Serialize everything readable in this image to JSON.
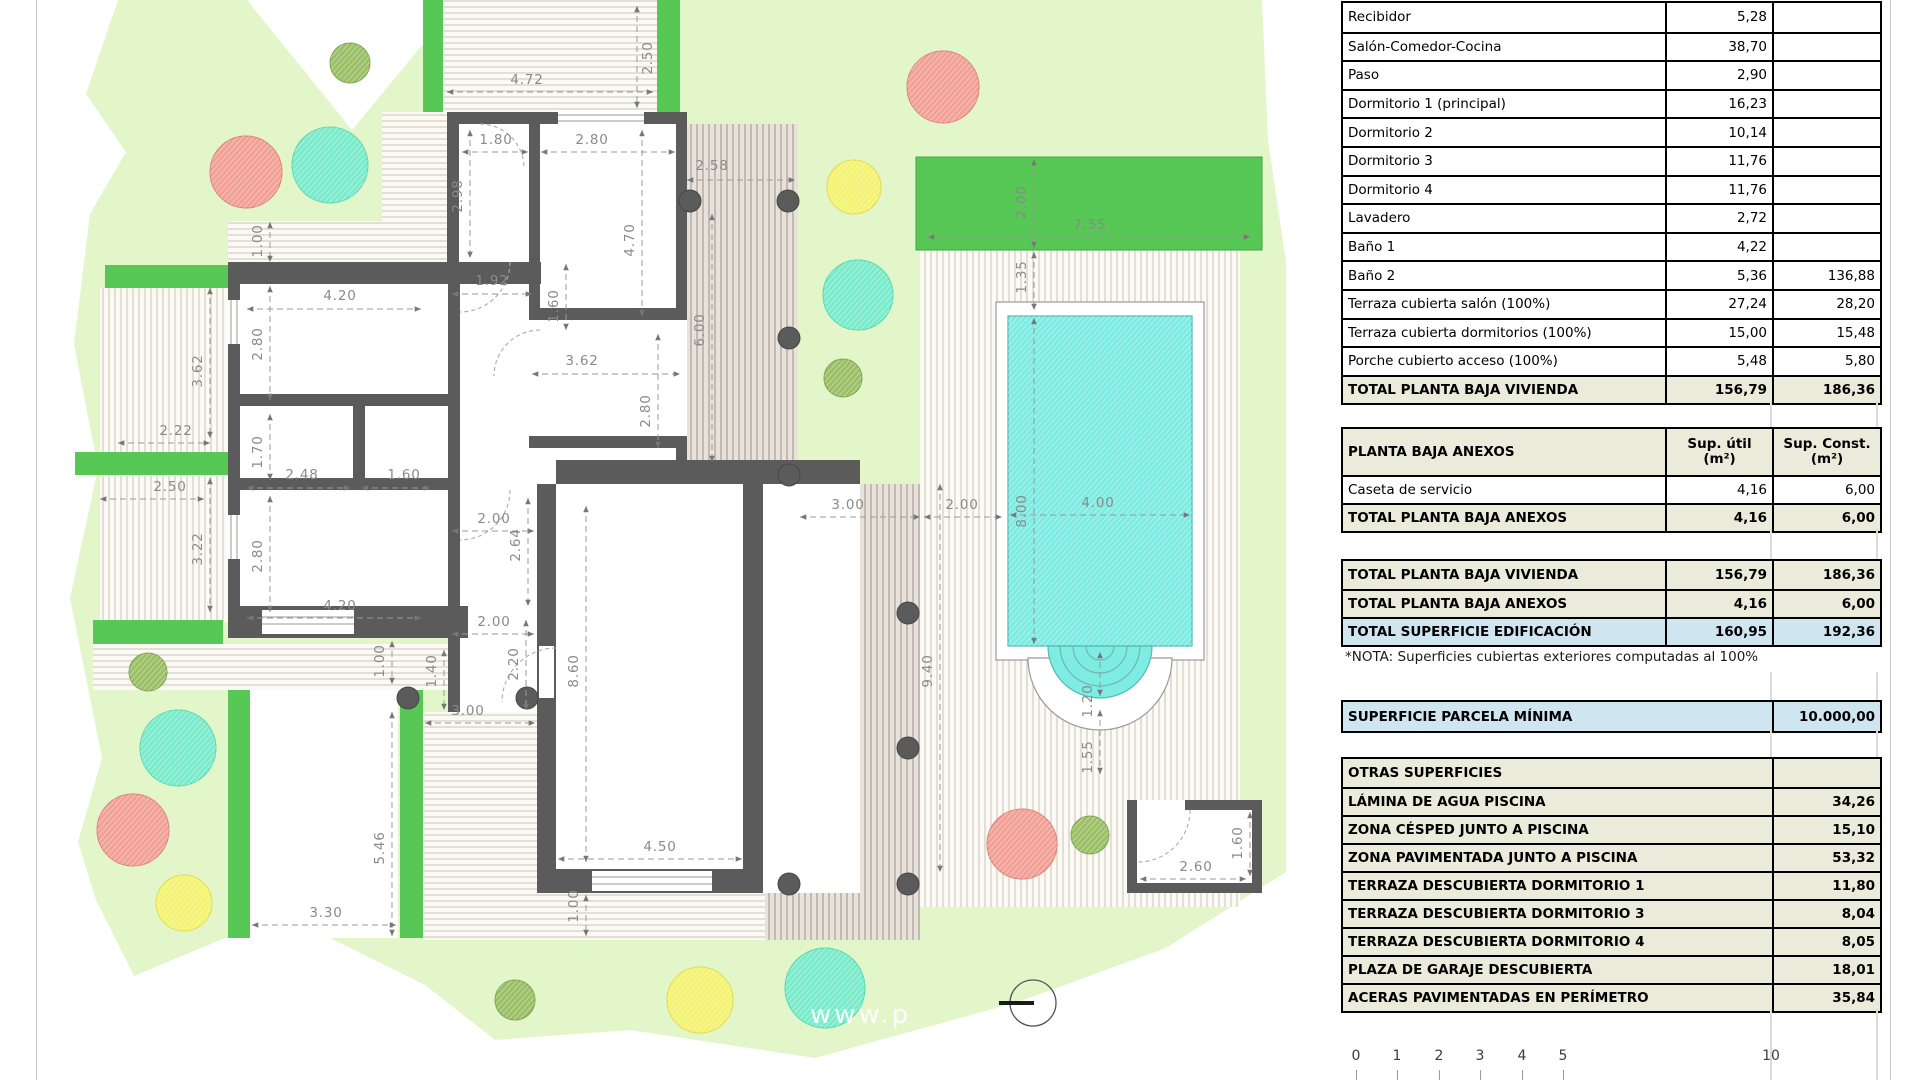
{
  "colors": {
    "parcel": "#E2F6CA",
    "hedge": "#57C756",
    "wall": "#5B5B5B",
    "pool_water": "#7EECE3",
    "table_total_bg": "#EBEBDB",
    "table_blue_bg": "#CFE6F1"
  },
  "plan": {
    "watermark": "www.p",
    "dimensions": [
      [
        "2.50",
        648,
        58,
        1,
        637,
        6,
        637,
        108
      ],
      [
        "4.72",
        527,
        80,
        0,
        447,
        92,
        653,
        92
      ],
      [
        "1.80",
        496,
        140,
        0,
        462,
        152,
        528,
        152
      ],
      [
        "2.80",
        592,
        140,
        0,
        541,
        152,
        675,
        152
      ],
      [
        "2.98",
        458,
        196,
        1,
        470,
        130,
        470,
        258
      ],
      [
        "4.70",
        630,
        240,
        1,
        642,
        130,
        642,
        316
      ],
      [
        "2.58",
        712,
        166,
        0,
        687,
        180,
        795,
        180
      ],
      [
        "1.00",
        258,
        241,
        1,
        270,
        222,
        270,
        262
      ],
      [
        "4.20",
        340,
        296,
        0,
        247,
        309,
        421,
        309
      ],
      [
        "2.80",
        258,
        344,
        1,
        270,
        286,
        270,
        400
      ],
      [
        "3.62",
        198,
        371,
        1,
        210,
        288,
        210,
        438
      ],
      [
        "1.92",
        492,
        281,
        0,
        452,
        294,
        532,
        294
      ],
      [
        "1.60",
        554,
        306,
        1,
        566,
        264,
        566,
        330
      ],
      [
        "3.62",
        582,
        361,
        0,
        532,
        374,
        680,
        374
      ],
      [
        "6.00",
        700,
        330,
        1,
        712,
        214,
        712,
        462
      ],
      [
        "2.22",
        176,
        431,
        0,
        118,
        443,
        210,
        443
      ],
      [
        "1.70",
        258,
        452,
        1,
        270,
        414,
        270,
        480
      ],
      [
        "2.48",
        302,
        475,
        0,
        247,
        488,
        350,
        488
      ],
      [
        "1.60",
        404,
        475,
        0,
        362,
        488,
        430,
        488
      ],
      [
        "2.50",
        170,
        487,
        0,
        100,
        499,
        204,
        499
      ],
      [
        "3.22",
        198,
        549,
        1,
        210,
        478,
        210,
        612
      ],
      [
        "2.80",
        258,
        556,
        1,
        270,
        496,
        270,
        612
      ],
      [
        "4.20",
        340,
        606,
        0,
        247,
        618,
        421,
        618
      ],
      [
        "2.80",
        646,
        411,
        1,
        658,
        334,
        658,
        448
      ],
      [
        "2.00",
        494,
        519,
        0,
        452,
        531,
        534,
        531
      ],
      [
        "2.64",
        516,
        545,
        1,
        528,
        498,
        528,
        606
      ],
      [
        "2.00",
        494,
        622,
        0,
        452,
        634,
        534,
        634
      ],
      [
        "2.20",
        514,
        664,
        1,
        526,
        620,
        526,
        710
      ],
      [
        "1.40",
        432,
        671,
        1,
        444,
        650,
        444,
        710
      ],
      [
        "1.00",
        380,
        661,
        1,
        392,
        641,
        392,
        684
      ],
      [
        "8.60",
        574,
        671,
        1,
        586,
        506,
        586,
        862
      ],
      [
        "3.00",
        468,
        711,
        0,
        425,
        723,
        535,
        723
      ],
      [
        "5.46",
        380,
        848,
        1,
        392,
        712,
        392,
        936
      ],
      [
        "3.30",
        326,
        913,
        0,
        252,
        925,
        396,
        925
      ],
      [
        "4.50",
        660,
        847,
        0,
        558,
        859,
        742,
        859
      ],
      [
        "1.00",
        574,
        906,
        1,
        586,
        895,
        586,
        936
      ],
      [
        "9.40",
        928,
        671,
        1,
        940,
        484,
        940,
        872
      ],
      [
        "2.00",
        1022,
        202,
        1,
        1034,
        159,
        1034,
        248
      ],
      [
        "7.55",
        1090,
        225,
        0,
        928,
        237,
        1250,
        237
      ],
      [
        "1.35",
        1022,
        277,
        1,
        1034,
        252,
        1034,
        310
      ],
      [
        "8.00",
        1022,
        511,
        1,
        1034,
        318,
        1034,
        644
      ],
      [
        "4.00",
        1098,
        503,
        0,
        1010,
        515,
        1190,
        515
      ],
      [
        "3.00",
        848,
        505,
        0,
        800,
        517,
        920,
        517
      ],
      [
        "2.00",
        962,
        505,
        0,
        924,
        517,
        1002,
        517
      ],
      [
        "1.20",
        1088,
        701,
        1,
        1100,
        652,
        1100,
        696
      ],
      [
        "1.55",
        1088,
        757,
        1,
        1100,
        710,
        1100,
        774
      ],
      [
        "2.60",
        1196,
        867,
        0,
        1140,
        879,
        1246,
        879
      ],
      [
        "1.60",
        1238,
        843,
        1,
        1250,
        812,
        1250,
        876
      ]
    ],
    "scale_bar": [
      [
        "0",
        1356
      ],
      [
        "1",
        1397
      ],
      [
        "2",
        1439
      ],
      [
        "3",
        1480
      ],
      [
        "4",
        1522
      ],
      [
        "5",
        1563
      ],
      [
        "10",
        1771
      ]
    ]
  },
  "tables": {
    "vivienda": {
      "rows": [
        [
          "Recibidor",
          "5,28",
          "",
          "n"
        ],
        [
          "Salón-Comedor-Cocina",
          "38,70",
          "",
          "n"
        ],
        [
          "Paso",
          "2,90",
          "",
          "n"
        ],
        [
          "Dormitorio 1 (principal)",
          "16,23",
          "",
          "n"
        ],
        [
          "Dormitorio 2",
          "10,14",
          "",
          "n"
        ],
        [
          "Dormitorio 3",
          "11,76",
          "",
          "n"
        ],
        [
          "Dormitorio 4",
          "11,76",
          "",
          "n"
        ],
        [
          "Lavadero",
          "2,72",
          "",
          "n"
        ],
        [
          "Baño 1",
          "4,22",
          "",
          "n"
        ],
        [
          "Baño 2",
          "5,36",
          "136,88",
          "n"
        ],
        [
          "Terraza cubierta salón (100%)",
          "27,24",
          "28,20",
          "n"
        ],
        [
          "Terraza cubierta dormitorios (100%)",
          "15,00",
          "15,48",
          "n"
        ],
        [
          "Porche cubierto acceso (100%)",
          "5,48",
          "5,80",
          "n"
        ],
        [
          "TOTAL PLANTA BAJA VIVIENDA",
          "156,79",
          "186,36",
          "t"
        ]
      ]
    },
    "anexos": {
      "title": "PLANTA BAJA ANEXOS",
      "col1a": "Sup. útil",
      "col1b": "(m²)",
      "col2a": "Sup. Const.",
      "col2b": "(m²)",
      "rows": [
        [
          "Caseta de servicio",
          "4,16",
          "6,00",
          "n"
        ],
        [
          "TOTAL PLANTA BAJA ANEXOS",
          "4,16",
          "6,00",
          "t"
        ]
      ]
    },
    "resumen": {
      "rows": [
        [
          "TOTAL PLANTA BAJA VIVIENDA",
          "156,79",
          "186,36",
          "t"
        ],
        [
          "TOTAL PLANTA BAJA ANEXOS",
          "4,16",
          "6,00",
          "t"
        ],
        [
          "TOTAL SUPERFICIE EDIFICACIÓN",
          "160,95",
          "192,36",
          "b"
        ]
      ]
    },
    "nota": "*NOTA: Superficies cubiertas exteriores computadas al 100%",
    "parcela": {
      "label": "SUPERFICIE PARCELA MÍNIMA",
      "value": "10.000,00"
    },
    "otras": {
      "rows": [
        [
          "OTRAS SUPERFICIES",
          ""
        ],
        [
          "LÁMINA DE AGUA PISCINA",
          "34,26"
        ],
        [
          "ZONA CÉSPED JUNTO A PISCINA",
          "15,10"
        ],
        [
          "ZONA PAVIMENTADA JUNTO A PISCINA",
          "53,32"
        ],
        [
          "TERRAZA DESCUBIERTA DORMITORIO 1",
          "11,80"
        ],
        [
          "TERRAZA DESCUBIERTA DORMITORIO 3",
          "8,04"
        ],
        [
          "TERRAZA DESCUBIERTA DORMITORIO 4",
          "8,05"
        ],
        [
          "PLAZA DE GARAJE DESCUBIERTA",
          "18,01"
        ],
        [
          "ACERAS PAVIMENTADAS EN PERÍMETRO",
          "35,84"
        ]
      ]
    }
  }
}
